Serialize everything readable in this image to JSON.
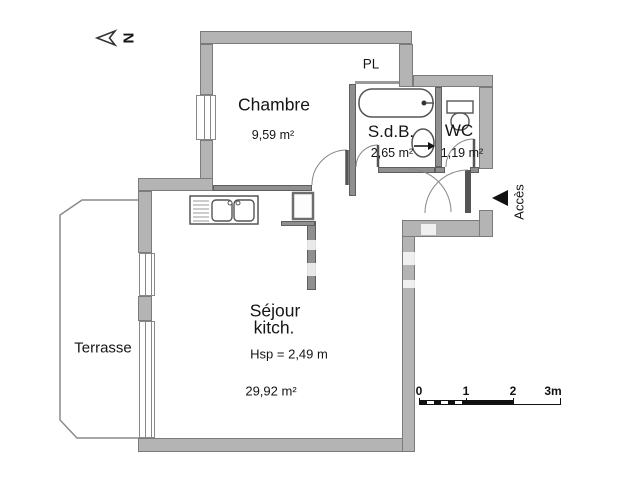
{
  "north": {
    "label": "N"
  },
  "access": {
    "label": "Accès"
  },
  "rooms": {
    "chambre": {
      "name": "Chambre",
      "area": "9,59 m²"
    },
    "placard": {
      "name": "PL"
    },
    "sdb": {
      "name": "S.d.B.",
      "area": "2,65 m²"
    },
    "wc": {
      "name": "WC",
      "area": "1,19 m²"
    },
    "sejour": {
      "line1": "Séjour",
      "line2": "kitch.",
      "ceiling_height": "Hsp = 2,49 m",
      "area": "29,92 m²"
    },
    "terrasse": {
      "name": "Terrasse"
    }
  },
  "scale": {
    "labels": [
      "0",
      "1",
      "2",
      "3m"
    ]
  },
  "colors": {
    "wall_fill": "#b4b4b4",
    "wall_border": "#7b7b7b",
    "partition_fill": "#8f8f8f",
    "fixture_stroke": "#555555",
    "access_arrow": "#111111"
  }
}
